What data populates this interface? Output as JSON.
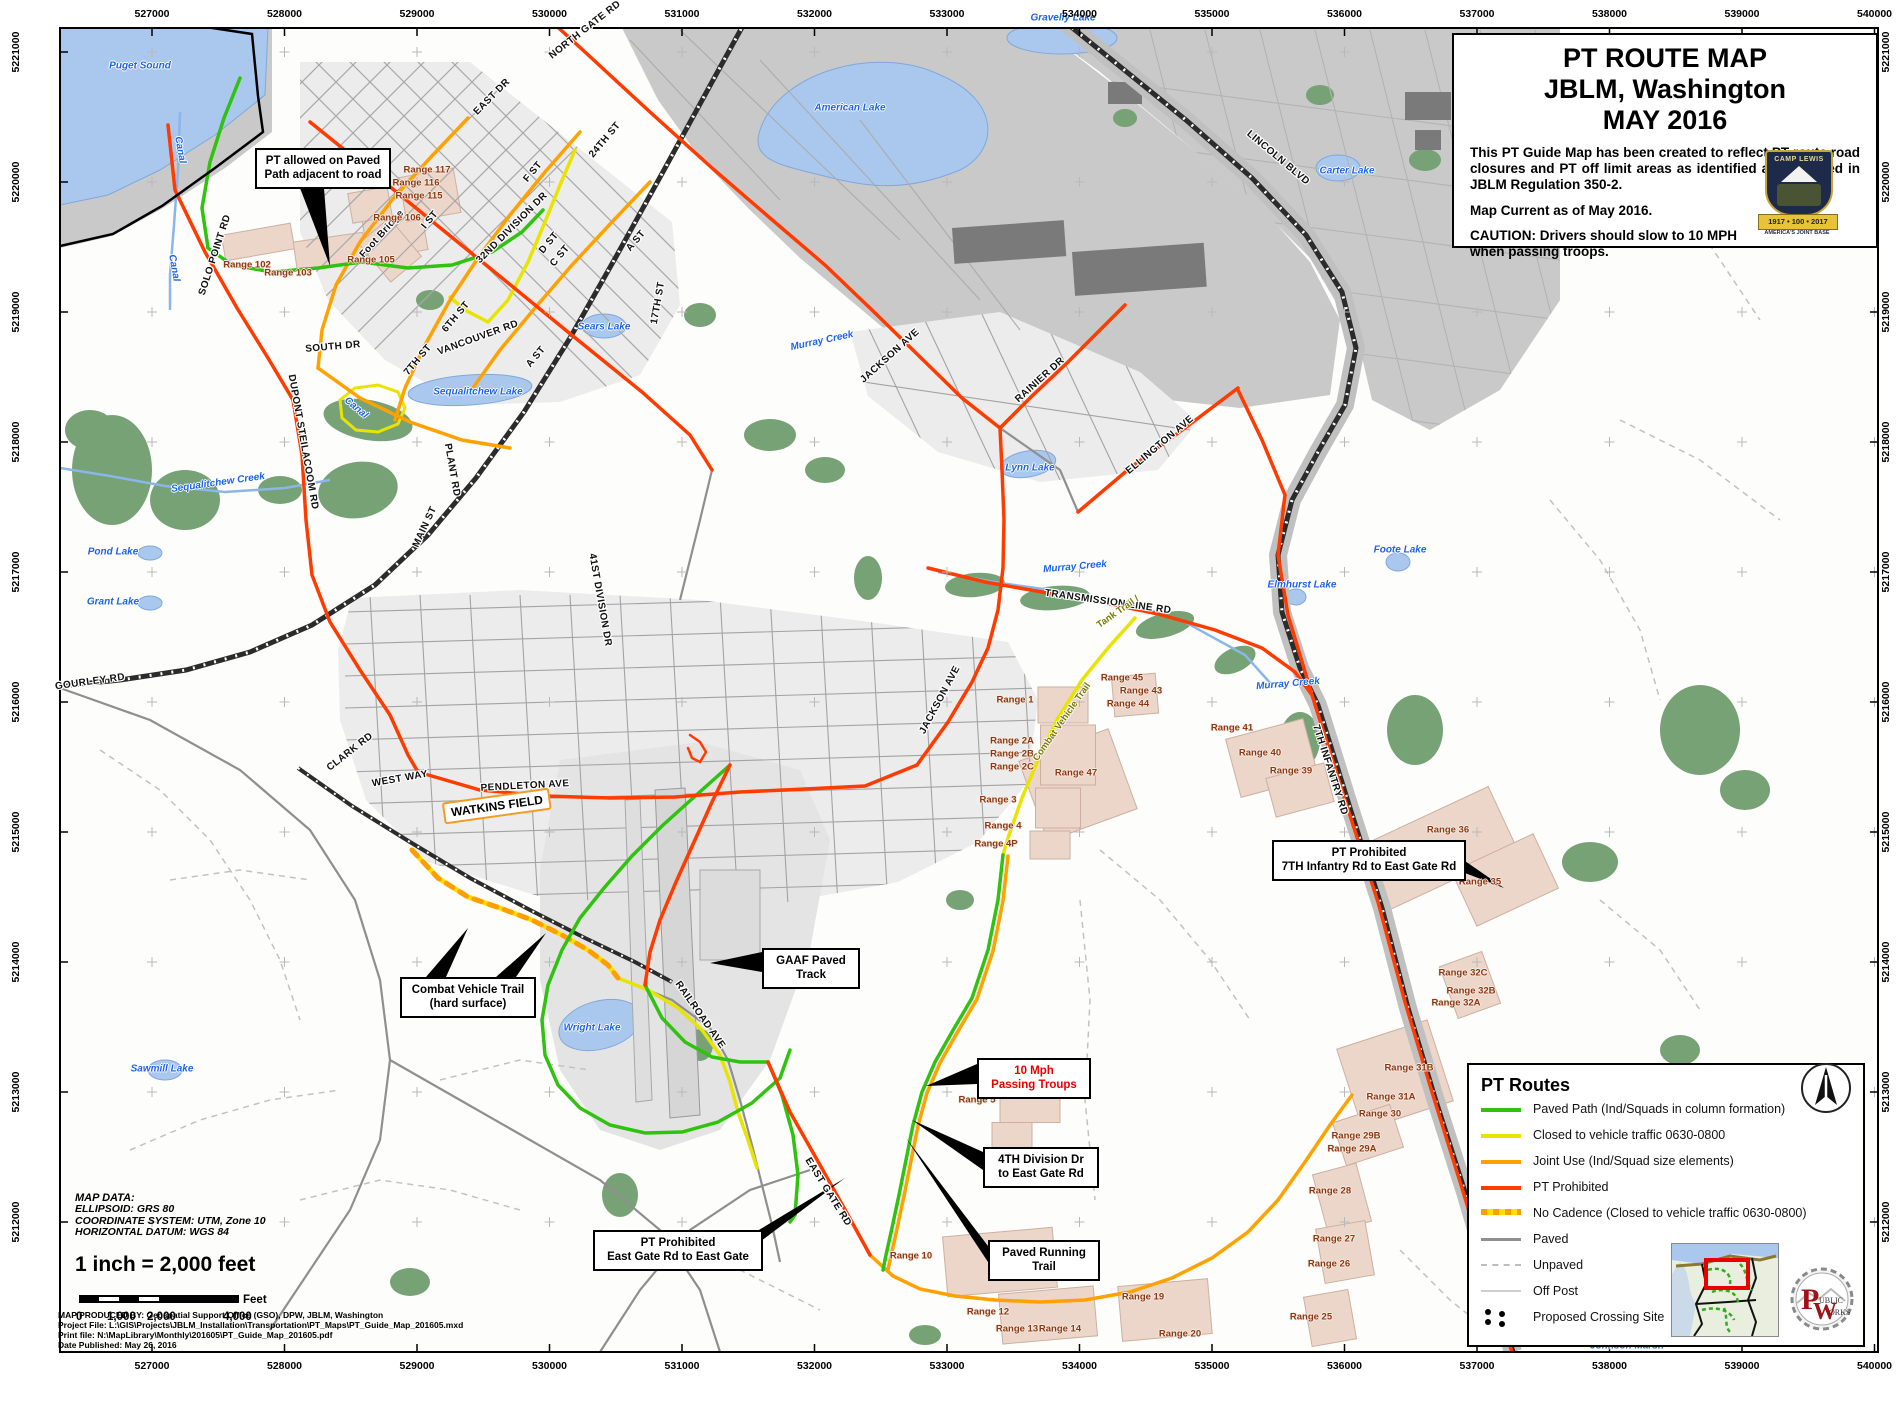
{
  "colors": {
    "route_green": "#2fc20e",
    "route_yellow": "#e8e400",
    "route_orange": "#ffa200",
    "route_red": "#ff3b00",
    "no_cadence_base": "#ffe000",
    "no_cadence_dash": "#ff9e00",
    "paved": "#8f8f8f",
    "unpaved": "#c2c2c2",
    "off_post_road": "#cfcfcf",
    "water": "#aac8ee",
    "water_label": "#1c64e8",
    "range_fill": "#ecd6ca",
    "range_label": "#8c3812",
    "off_post_area": "#c9c9c9",
    "vegetation": "#76a276",
    "accent_orange": "#f59a23"
  },
  "title_box": {
    "line1": "PT ROUTE MAP",
    "line2": "JBLM, Washington",
    "line3": "MAY 2016",
    "paragraph": "This PT Guide Map has been created to reflect PT route road closures and PT off limit areas as identified and updated in JBLM Regulation 350-2.",
    "current": "Map Current as of May 2016.",
    "caution": "CAUTION: Drivers should slow to 10 MPH when passing troops.",
    "crest": {
      "arc_text": "CAMP LEWIS",
      "banner": "1917 • 100 • 2017",
      "sub": "AMERICA'S JOINT BASE"
    }
  },
  "legend": {
    "title": "PT Routes",
    "items": [
      {
        "swatch": "green",
        "label": "Paved Path (Ind/Squads in column formation)"
      },
      {
        "swatch": "yellow",
        "label": "Closed to vehicle traffic 0630-0800"
      },
      {
        "swatch": "orange",
        "label": "Joint Use (Ind/Squad size elements)"
      },
      {
        "swatch": "red",
        "label": "PT Prohibited"
      },
      {
        "swatch": "nocadence",
        "label": "No Cadence (Closed to vehicle traffic 0630-0800)"
      },
      {
        "swatch": "paved",
        "label": "Paved"
      },
      {
        "swatch": "unpaved",
        "label": "Unpaved"
      },
      {
        "swatch": "offpost",
        "label": "Off Post"
      },
      {
        "swatch": "dots",
        "label": "Proposed Crossing Site"
      }
    ],
    "pw_logo": {
      "letters": "PW",
      "line1": "UBLIC",
      "line2": "ORKS"
    }
  },
  "map_data_block": {
    "heading": "MAP DATA:",
    "lines": [
      "ELLIPSOID:  GRS 80",
      "COORDINATE SYSTEM:  UTM, Zone 10",
      "HORIZONTAL DATUM:  WGS 84"
    ],
    "scale_text": "1 inch = 2,000 feet",
    "scale_unit": "Feet",
    "scale_ticks": [
      "0",
      "1,000",
      "2,000",
      "4,000"
    ]
  },
  "credits": [
    "MAP PRODUCED BY: Geospatial Support Office (GSO), DPW,  JBLM, Washington",
    "Project File: L:\\GIS\\Projects\\JBLM_Installation\\Transportation\\PT_Maps\\PT_Guide_Map_201605.mxd",
    "Print file: N:\\MapLibrary\\Monthly\\201605\\PT_Guide_Map_201605.pdf",
    "Date Published:  May 26, 2016"
  ],
  "grid": {
    "top_labels": [
      "527000",
      "528000",
      "529000",
      "530000",
      "531000",
      "532000",
      "533000",
      "534000",
      "535000",
      "536000",
      "537000",
      "538000",
      "539000",
      "540000"
    ],
    "bottom_labels": [
      "527000",
      "528000",
      "529000",
      "530000",
      "531000",
      "532000",
      "533000",
      "534000",
      "535000",
      "536000",
      "537000",
      "538000",
      "539000",
      "540000"
    ],
    "left_labels": [
      "5221000",
      "5220000",
      "5219000",
      "5218000",
      "5217000",
      "5216000",
      "5215000",
      "5214000",
      "5213000",
      "5212000"
    ],
    "right_labels": [
      "5221000",
      "5220000",
      "5219000",
      "5218000",
      "5217000",
      "5216000",
      "5215000",
      "5214000",
      "5213000",
      "5212000"
    ]
  },
  "callouts": [
    {
      "id": "pt-allowed",
      "lines": [
        "PT allowed on Paved",
        "Path adjacent to road"
      ],
      "x": 255,
      "y": 148,
      "w": 122,
      "red": false,
      "tails": [
        [
          330,
          266,
          300,
          188,
          324,
          188
        ]
      ]
    },
    {
      "id": "combat-vehicle-trail",
      "lines": [
        "Combat Vehicle Trail",
        "(hard surface)"
      ],
      "x": 400,
      "y": 977,
      "w": 122,
      "red": false,
      "tails": [
        [
          468,
          928,
          426,
          977,
          446,
          977
        ],
        [
          546,
          933,
          496,
          977,
          516,
          977
        ]
      ]
    },
    {
      "id": "gaaf-paved-track",
      "lines": [
        "GAAF Paved",
        "Track"
      ],
      "x": 762,
      "y": 948,
      "w": 84,
      "red": false,
      "tails": [
        [
          710,
          963,
          762,
          952,
          762,
          972
        ]
      ]
    },
    {
      "id": "ten-mph",
      "lines": [
        "10 Mph",
        "Passing Troups"
      ],
      "x": 977,
      "y": 1058,
      "w": 100,
      "red": true,
      "tails": [
        [
          926,
          1086,
          977,
          1064,
          977,
          1084
        ]
      ]
    },
    {
      "id": "fourth-division",
      "lines": [
        "4TH Division Dr",
        "to East Gate Rd"
      ],
      "x": 983,
      "y": 1147,
      "w": 102,
      "red": false,
      "tails": [
        [
          912,
          1120,
          983,
          1152,
          983,
          1170
        ]
      ]
    },
    {
      "id": "paved-running-trail",
      "lines": [
        "Paved Running",
        "Trail"
      ],
      "x": 988,
      "y": 1240,
      "w": 98,
      "red": false,
      "tails": [
        [
          906,
          1138,
          988,
          1246,
          988,
          1262
        ]
      ]
    },
    {
      "id": "east-gate-prohibited",
      "lines": [
        "PT Prohibited",
        "East Gate Rd to East Gate"
      ],
      "x": 593,
      "y": 1230,
      "w": 156,
      "red": false,
      "tails": [
        [
          845,
          1178,
          749,
          1236,
          749,
          1250
        ]
      ]
    },
    {
      "id": "seventh-infantry-prohibited",
      "lines": [
        "PT Prohibited",
        "7TH Infantry Rd to East Gate Rd"
      ],
      "x": 1272,
      "y": 840,
      "w": 180,
      "red": false,
      "tails": [
        [
          1504,
          888,
          1452,
          852,
          1452,
          868
        ]
      ]
    }
  ],
  "labels": {
    "roads": [
      [
        "NORTH GATE RD",
        585,
        30,
        -38
      ],
      [
        "EAST DR",
        492,
        97,
        -45
      ],
      [
        "24TH ST",
        605,
        140,
        -50
      ],
      [
        "F ST",
        533,
        172,
        -50
      ],
      [
        "I ST",
        430,
        220,
        -50
      ],
      [
        "32ND DIVISION DR",
        512,
        228,
        -45
      ],
      [
        "D ST",
        549,
        243,
        -50
      ],
      [
        "C ST",
        560,
        256,
        -50
      ],
      [
        "A ST",
        636,
        241,
        -50
      ],
      [
        "A ST",
        536,
        357,
        -50
      ],
      [
        "6TH ST",
        456,
        317,
        -50
      ],
      [
        "7TH ST",
        418,
        360,
        -50
      ],
      [
        "17TH ST",
        658,
        303,
        -80
      ],
      [
        "Foot Bridge",
        382,
        234,
        -48
      ],
      [
        "SOLO POINT RD",
        215,
        255,
        -72
      ],
      [
        "VANCOUVER RD",
        478,
        338,
        -20
      ],
      [
        "SOUTH DR",
        333,
        347,
        -5
      ],
      [
        "DUPONT STEILACOOM RD",
        303,
        442,
        80
      ],
      [
        "PLANT RD",
        452,
        470,
        80
      ],
      [
        "MAIN ST",
        425,
        527,
        -65
      ],
      [
        "41ST DIVISION DR",
        600,
        600,
        80
      ],
      [
        "CLARK RD",
        350,
        752,
        -38
      ],
      [
        "WEST WAY",
        400,
        779,
        -10
      ],
      [
        "PENDLETON AVE",
        525,
        786,
        -3
      ],
      [
        "JACKSON AVE",
        890,
        356,
        -42
      ],
      [
        "JACKSON AVE",
        940,
        700,
        -62
      ],
      [
        "RAINIER DR",
        1040,
        380,
        -42
      ],
      [
        "ELLINGTON AVE",
        1160,
        445,
        -40
      ],
      [
        "LINCOLN BLVD",
        1278,
        158,
        40
      ],
      [
        "TRANSMISSION LINE RD",
        1108,
        602,
        8
      ],
      [
        "7TH INFANTRY RD",
        1330,
        770,
        72
      ],
      [
        "RAILROAD AVE",
        700,
        1015,
        55
      ],
      [
        "EAST GATE RD",
        828,
        1192,
        58
      ],
      [
        "GOURLEY RD",
        90,
        682,
        -8
      ]
    ],
    "water": [
      [
        "Puget Sound",
        140,
        66,
        0
      ],
      [
        "Canal",
        180,
        150,
        80
      ],
      [
        "Canal",
        174,
        268,
        80
      ],
      [
        "Canal",
        356,
        408,
        40
      ],
      [
        "Sequalitchew Creek",
        218,
        483,
        -8
      ],
      [
        "Sequalitchew Lake",
        478,
        392,
        0
      ],
      [
        "Sears Lake",
        604,
        327,
        0
      ],
      [
        "American Lake",
        850,
        108,
        0
      ],
      [
        "Gravelly Lake",
        1063,
        18,
        0
      ],
      [
        "Carter Lake",
        1347,
        171,
        0
      ],
      [
        "Murray Creek",
        822,
        341,
        -12
      ],
      [
        "Murray Creek",
        1075,
        567,
        -5
      ],
      [
        "Murray Creek",
        1288,
        684,
        -5
      ],
      [
        "Lynn Lake",
        1030,
        468,
        0
      ],
      [
        "Pond Lake",
        113,
        552,
        0
      ],
      [
        "Grant Lake",
        113,
        602,
        0
      ],
      [
        "Foote Lake",
        1400,
        550,
        0
      ],
      [
        "Elmhurst Lake",
        1302,
        585,
        0
      ],
      [
        "Sawmill Lake",
        162,
        1069,
        0
      ],
      [
        "Wright Lake",
        592,
        1028,
        0
      ],
      [
        "Johnson Marsh",
        1627,
        1346,
        0
      ]
    ],
    "ranges": [
      [
        "Range 117",
        427,
        170
      ],
      [
        "Range 116",
        416,
        183
      ],
      [
        "Range 115",
        419,
        196
      ],
      [
        "Range 106",
        397,
        218
      ],
      [
        "Range 105",
        371,
        260
      ],
      [
        "Range 102",
        247,
        265
      ],
      [
        "Range 103",
        288,
        273
      ],
      [
        "Range 45",
        1122,
        678
      ],
      [
        "Range 43",
        1141,
        691
      ],
      [
        "Range 44",
        1128,
        704
      ],
      [
        "Range 41",
        1232,
        728
      ],
      [
        "Range 40",
        1260,
        753
      ],
      [
        "Range 39",
        1291,
        771
      ],
      [
        "Range 47",
        1076,
        773
      ],
      [
        "Range 36",
        1448,
        830
      ],
      [
        "Range 35",
        1480,
        882
      ],
      [
        "Range 32C",
        1463,
        973
      ],
      [
        "Range 32B",
        1471,
        991
      ],
      [
        "Range 32A",
        1456,
        1003
      ],
      [
        "Range 31B",
        1409,
        1068
      ],
      [
        "Range 31A",
        1391,
        1097
      ],
      [
        "Range 30",
        1380,
        1114
      ],
      [
        "Range 29B",
        1356,
        1136
      ],
      [
        "Range 29A",
        1352,
        1149
      ],
      [
        "Range 28",
        1330,
        1191
      ],
      [
        "Range 27",
        1334,
        1239
      ],
      [
        "Range 26",
        1329,
        1264
      ],
      [
        "Range 25",
        1311,
        1317
      ],
      [
        "Range 1",
        1015,
        700
      ],
      [
        "Range 2A",
        1012,
        741
      ],
      [
        "Range 2B",
        1012,
        754
      ],
      [
        "Range 2C",
        1012,
        767
      ],
      [
        "Range 3",
        998,
        800
      ],
      [
        "Range 4",
        1003,
        826
      ],
      [
        "Range 4P",
        996,
        844
      ],
      [
        "Range 5",
        977,
        1100
      ],
      [
        "Range 10",
        911,
        1256
      ],
      [
        "Range 12",
        988,
        1312
      ],
      [
        "Range 13",
        1017,
        1329
      ],
      [
        "Range 14",
        1060,
        1329
      ],
      [
        "Range 19",
        1143,
        1297
      ],
      [
        "Range 20",
        1180,
        1334
      ]
    ],
    "trails": [
      [
        "Tank Trail /",
        1118,
        612,
        -35
      ],
      [
        "Combat Vehicle Trail",
        1062,
        722,
        -55
      ]
    ],
    "places": [
      [
        "WATKINS FIELD",
        497,
        806,
        -8
      ]
    ]
  }
}
